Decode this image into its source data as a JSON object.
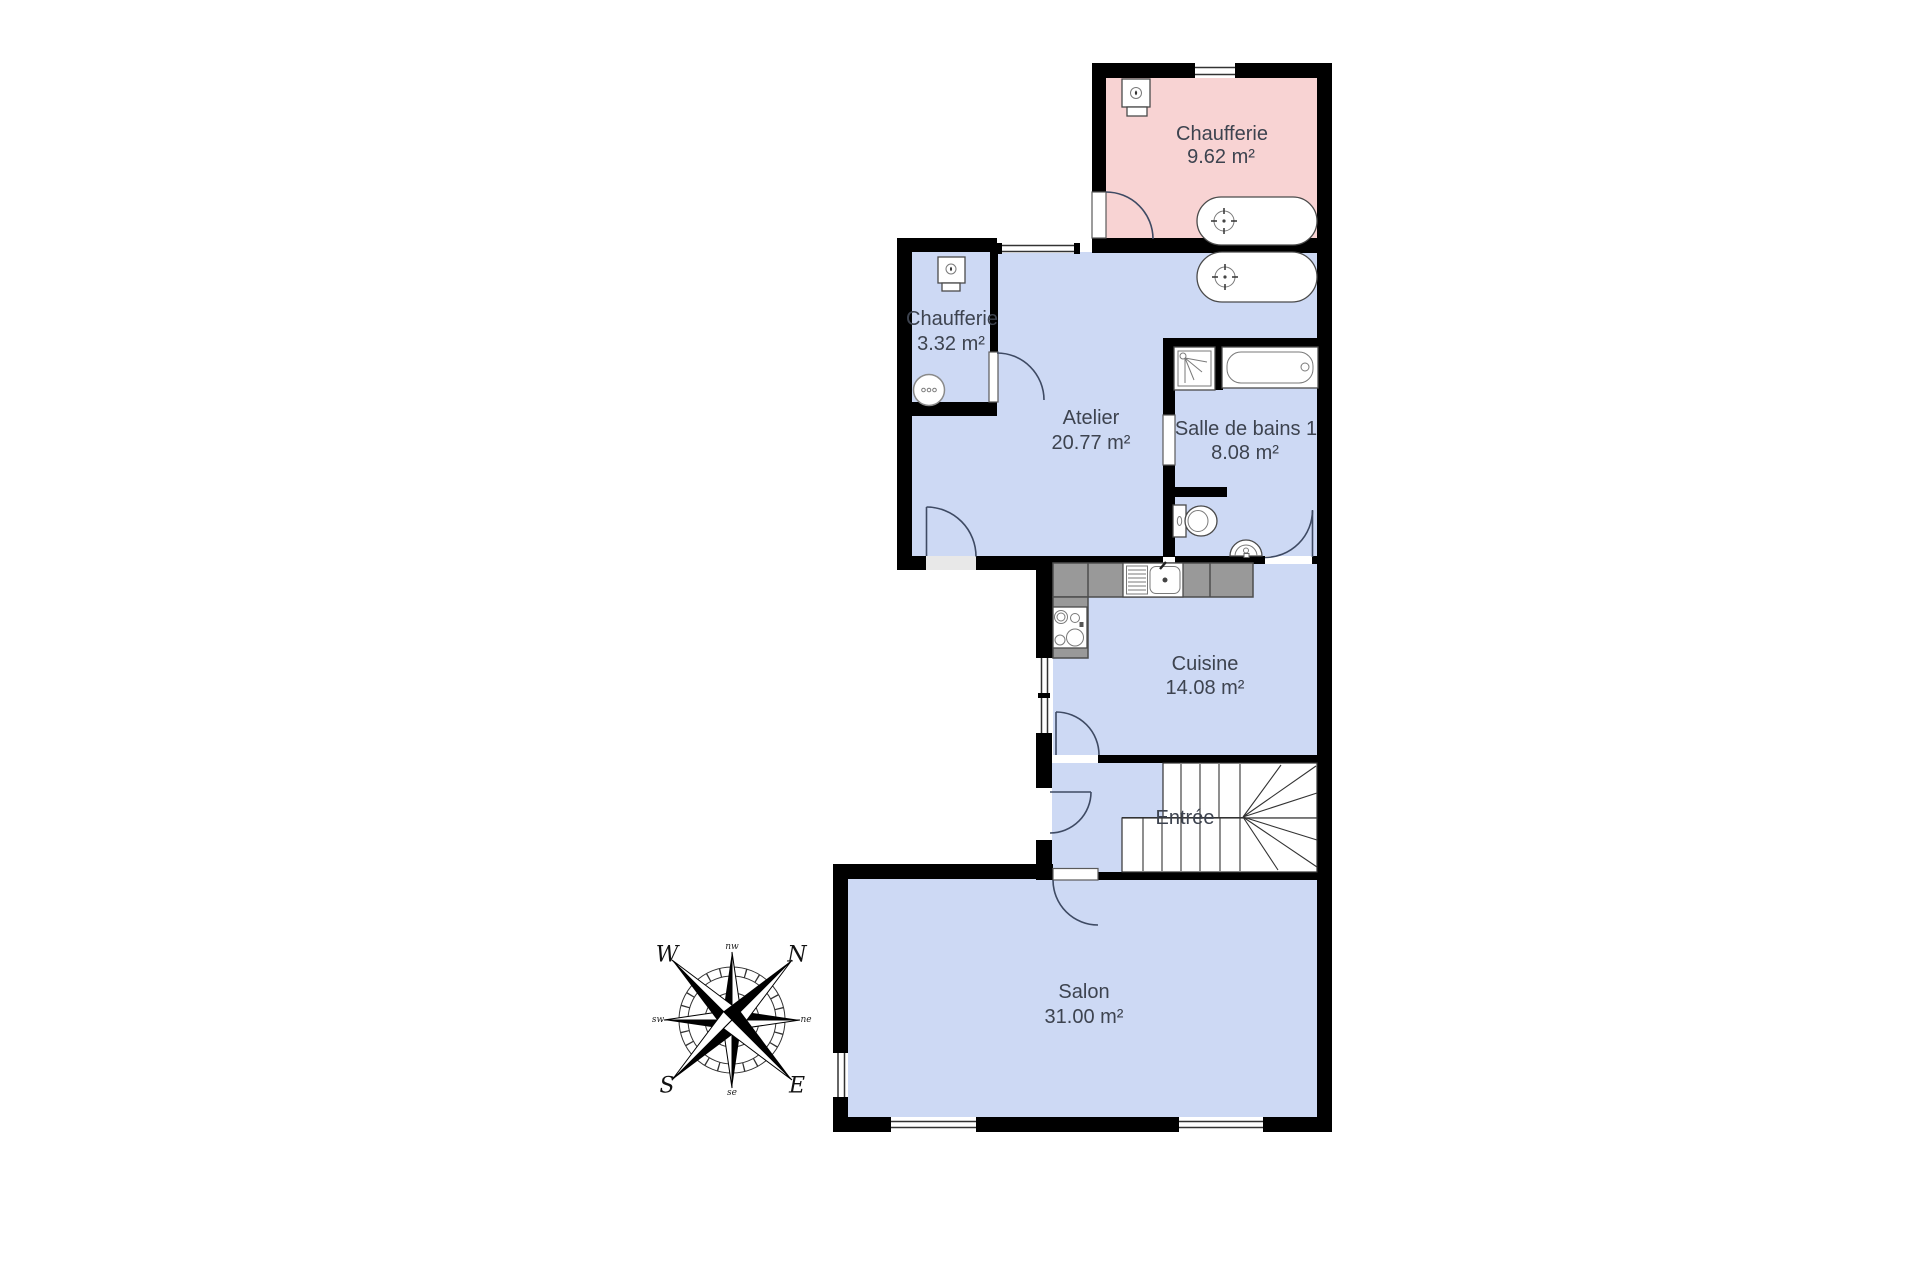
{
  "plan": {
    "rooms": [
      {
        "key": "chaufferie_1",
        "label": "Chaufferie",
        "area": "9.62 m²"
      },
      {
        "key": "chaufferie_2",
        "label": "Chaufferie",
        "area": "3.32 m²"
      },
      {
        "key": "atelier",
        "label": "Atelier",
        "area": "20.77 m²"
      },
      {
        "key": "salle_de_bains",
        "label": "Salle de bains 1",
        "area": "8.08 m²"
      },
      {
        "key": "cuisine",
        "label": "Cuisine",
        "area": "14.08 m²"
      },
      {
        "key": "entree",
        "label": "Entrée",
        "area": ""
      },
      {
        "key": "salon",
        "label": "Salon",
        "area": "31.00 m²"
      }
    ],
    "compass": {
      "w": "W",
      "n": "N",
      "s": "S",
      "e": "E",
      "nw": "nw",
      "ne": "ne",
      "sw": "sw",
      "se": "se"
    },
    "colors": {
      "room_fill": "#cdd9f4",
      "chaufferie_fill": "#f8d3d3",
      "wall": "#000000",
      "text": "#3d434f",
      "counter": "#999999",
      "counter_border": "#4d4d4d",
      "threshold": "#e8e8e8"
    }
  }
}
